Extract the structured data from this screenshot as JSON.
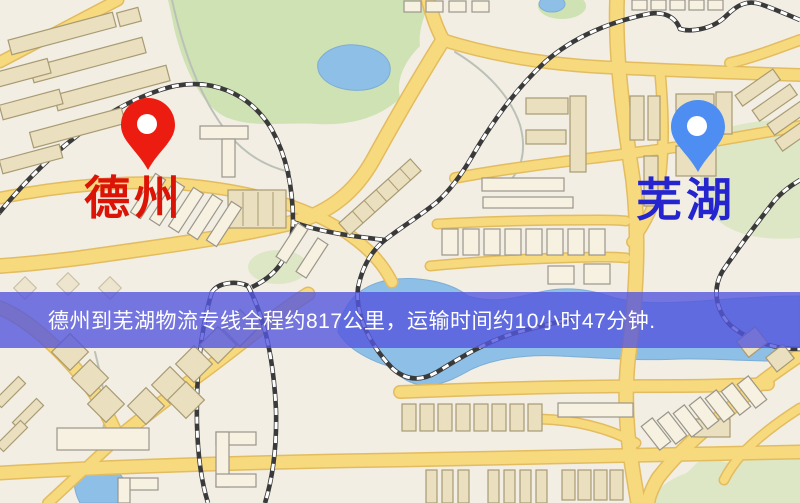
{
  "canvas": {
    "width": 800,
    "height": 503
  },
  "route_banner": {
    "text": "德州到芜湖物流专线全程约817公里，运输时间约10小时47分钟.",
    "distance_text": "817公里",
    "duration_text": "10小时47分钟",
    "background_color": "#5456dd",
    "text_color": "#ffffff"
  },
  "markers": {
    "origin": {
      "label": "德州",
      "pin_color": "#ec1c10",
      "label_color": "#dc1408"
    },
    "destination": {
      "label": "芜湖",
      "pin_color": "#4e8df2",
      "label_color": "#2525cf"
    }
  },
  "map_palette": {
    "background": "#f2eee3",
    "road_fill": "#f7d97e",
    "road_casing": "#e3bc60",
    "building_fill": "#eadfbe",
    "building_light_fill": "#f6f1e1",
    "park": "#cfe2b4",
    "water": "#8ebfe6",
    "railway_dark": "#3a3a3a",
    "railway_light": "#ffffff"
  }
}
